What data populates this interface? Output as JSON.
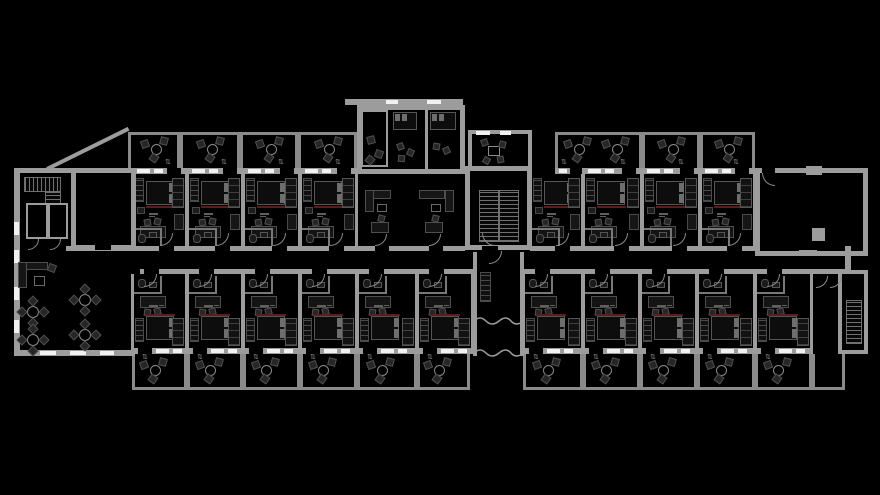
{
  "title": "architectural-floor-plan",
  "palette": {
    "bg": "#000000",
    "wall": "#9c9c9c",
    "wallLight": "#c2c2c2",
    "rail": "#8a8a8a",
    "innerLine": "#6f6f6f",
    "furnDark": "#101010",
    "furnMid": "#262626",
    "furnEdge": "#555555",
    "pillow": "#6e6e6e",
    "accent": "#5a1c1c",
    "window": "#f1f1f1",
    "hatchLine": "#707070",
    "labelMark": "#5f5f5f"
  },
  "rows": {
    "balTopY": 132,
    "balTopH": 36,
    "winTopY": 168,
    "winTopH": 6,
    "roomTopY": 174,
    "roomTopH": 72,
    "corWallTopY": 246,
    "corWallH": 5,
    "corWallBotY": 269,
    "roomBotY": 274,
    "roomBotH": 74,
    "winBotY": 348,
    "winBotH": 6,
    "balBotY": 354,
    "balBotH": 36,
    "railBotY": 387
  },
  "top_rooms": [
    {
      "x": 132,
      "w": 55
    },
    {
      "x": 187,
      "w": 56
    },
    {
      "x": 243,
      "w": 57
    },
    {
      "x": 300,
      "w": 57
    },
    {
      "x": 530,
      "w": 53,
      "winFrom": 555
    },
    {
      "x": 583,
      "w": 59
    },
    {
      "x": 642,
      "w": 58
    },
    {
      "x": 700,
      "w": 55
    }
  ],
  "bottom_rooms": [
    {
      "x": 132,
      "w": 55
    },
    {
      "x": 187,
      "w": 56
    },
    {
      "x": 243,
      "w": 57
    },
    {
      "x": 300,
      "w": 57
    },
    {
      "x": 357,
      "w": 60
    },
    {
      "x": 417,
      "w": 56
    },
    {
      "x": 523,
      "w": 60
    },
    {
      "x": 583,
      "w": 57
    },
    {
      "x": 640,
      "w": 57
    },
    {
      "x": 697,
      "w": 58
    },
    {
      "x": 755,
      "w": 57
    }
  ],
  "top_balconies": [
    {
      "x": 128,
      "w": 52
    },
    {
      "x": 180,
      "w": 60
    },
    {
      "x": 240,
      "w": 58
    },
    {
      "x": 298,
      "w": 59
    },
    {
      "x": 555,
      "w": 87,
      "double": true
    },
    {
      "x": 642,
      "w": 58
    },
    {
      "x": 700,
      "w": 55
    }
  ],
  "bottom_balconies": [
    {
      "x": 132,
      "w": 55
    },
    {
      "x": 187,
      "w": 56
    },
    {
      "x": 243,
      "w": 57
    },
    {
      "x": 300,
      "w": 57
    },
    {
      "x": 357,
      "w": 60
    },
    {
      "x": 417,
      "w": 53
    },
    {
      "x": 523,
      "w": 60
    },
    {
      "x": 583,
      "w": 57
    },
    {
      "x": 640,
      "w": 57
    },
    {
      "x": 697,
      "w": 58
    },
    {
      "x": 755,
      "w": 57
    },
    {
      "x": 812,
      "w": 33,
      "empty": true
    }
  ],
  "corridor": {
    "topSegs": [
      [
        66,
        465
      ],
      [
        530,
        755
      ]
    ],
    "botSegs": [
      [
        140,
        473
      ],
      [
        520,
        845
      ]
    ],
    "rightCap": [
      845,
      246,
      6,
      28
    ]
  },
  "center_block": {
    "outer": {
      "x": 357,
      "y": 105,
      "w": 108,
      "h": 69
    },
    "divider": {
      "x": 425,
      "y": 110,
      "h": 64
    },
    "loggia": {
      "x": 361,
      "y": 110,
      "w": 27,
      "h": 57
    },
    "beds": [
      {
        "x": 393,
        "y": 112,
        "w": 24,
        "h": 18
      },
      {
        "x": 430,
        "y": 112,
        "w": 26,
        "h": 18
      }
    ],
    "canopy": {
      "x": 345,
      "y": 99,
      "w": 118,
      "h": 6
    },
    "canopyWindows": [
      [
        386,
        12
      ],
      [
        427,
        14
      ]
    ],
    "living": [
      {
        "x": 357,
        "w": 54
      },
      {
        "x": 411,
        "w": 54
      }
    ]
  },
  "lobby": {
    "room": {
      "x": 465,
      "y": 166,
      "w": 67,
      "h": 84
    },
    "stair": {
      "x": 479,
      "y": 190,
      "w": 40,
      "h": 52
    },
    "window": [
      480,
      16
    ],
    "upperRoom": {
      "x": 468,
      "y": 130,
      "w": 64,
      "h": 40
    },
    "upperWindows": [
      [
        476,
        14
      ],
      [
        500,
        11
      ]
    ]
  },
  "right_room": {
    "x": 755,
    "y": 168,
    "w": 113,
    "h": 88,
    "column": {
      "x": 812,
      "y": 228,
      "s": 13
    },
    "ticks": [
      [
        806,
        166,
        16,
        9
      ],
      [
        799,
        250,
        18,
        6
      ]
    ],
    "doorGap": [
      762,
      168,
      13
    ]
  },
  "left_block": {
    "sideWall": [
      14,
      168,
      6,
      188
    ],
    "topWall": [
      14,
      168,
      60,
      5
    ],
    "bigRoom": [
      71,
      168,
      65,
      82
    ],
    "bigRoomGap": [
      95,
      245,
      16
    ],
    "stairRunH": [
      24,
      177,
      37,
      15
    ],
    "stairRunV": [
      45,
      192,
      16,
      13
    ],
    "smallRooms": [
      [
        26,
        203,
        22,
        36
      ],
      [
        48,
        203,
        20,
        36
      ]
    ],
    "bottomWall": [
      19,
      350,
      116,
      6
    ],
    "bottomWindows": [
      [
        40,
        16
      ],
      [
        70,
        16
      ],
      [
        100,
        14
      ]
    ],
    "sideWindows": [
      222,
      250,
      287,
      320
    ],
    "diagWall": {
      "x": 47,
      "y": 167,
      "len": 91,
      "angle": -26.3
    }
  },
  "lounge": {
    "sofa": {
      "x": 18,
      "y": 262
    },
    "tables": [
      [
        33,
        312
      ],
      [
        33,
        340
      ],
      [
        85,
        300
      ],
      [
        85,
        335
      ]
    ]
  },
  "connector": {
    "walls": [
      [
        473,
        252,
        4,
        104
      ],
      [
        520,
        252,
        4,
        104
      ]
    ],
    "shaft": [
      480,
      272,
      11,
      30
    ],
    "breaks": [
      [
        474,
        314
      ],
      [
        474,
        346
      ]
    ]
  },
  "right_stair": {
    "outline": [
      838,
      270,
      30,
      84
    ],
    "hatch": [
      846,
      300,
      16,
      44
    ],
    "hallArcs": [
      [
        816,
        276
      ],
      [
        830,
        276
      ]
    ]
  }
}
